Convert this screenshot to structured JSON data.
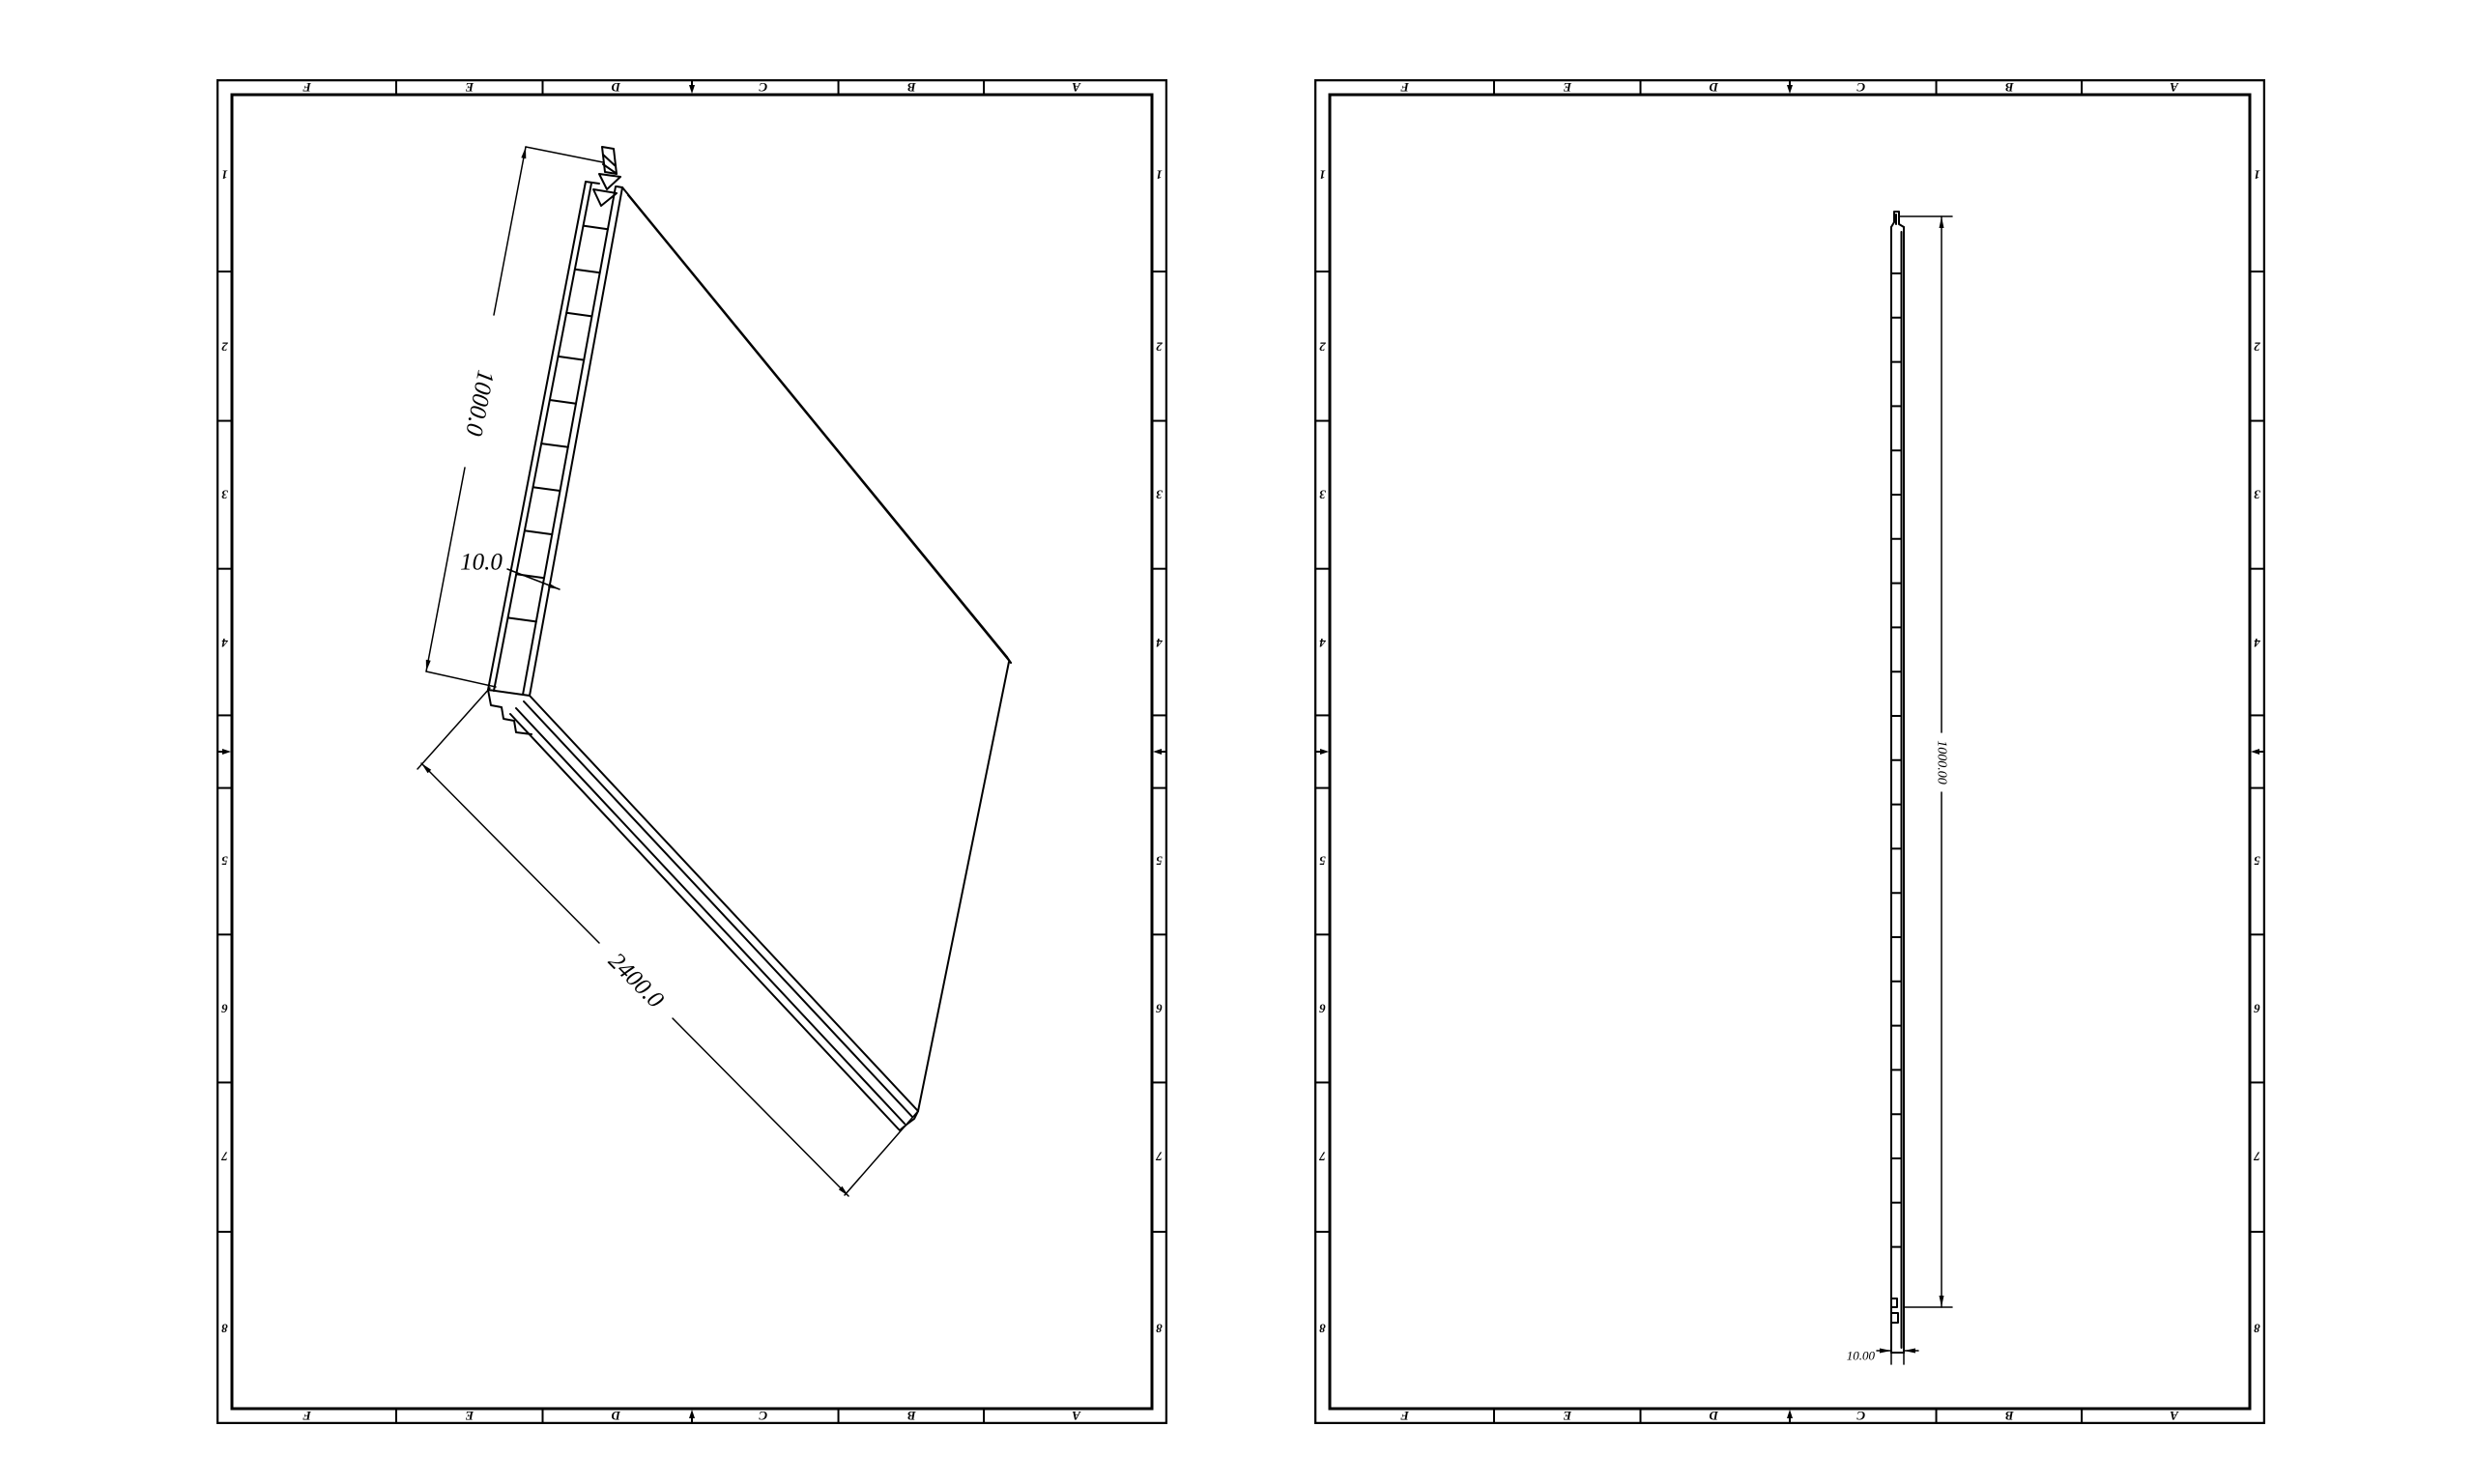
{
  "page": {
    "background": "#ffffff",
    "line_color": "#000000",
    "description": "Two CAD drawing sheets of a hollow-core panel"
  },
  "sheets": [
    {
      "id": "left",
      "view_name": "panel-isometric-view",
      "frame": {
        "column_labels": [
          "F",
          "E",
          "D",
          "C",
          "B",
          "A"
        ],
        "row_labels": [
          "1",
          "2",
          "3",
          "4",
          "5",
          "6",
          "7",
          "8"
        ]
      },
      "dimensions": {
        "length": "1000.0",
        "thickness": "10.0",
        "width": "2400.0"
      }
    },
    {
      "id": "right",
      "view_name": "panel-side-view",
      "frame": {
        "column_labels": [
          "F",
          "E",
          "D",
          "C",
          "B",
          "A"
        ],
        "row_labels": [
          "1",
          "2",
          "3",
          "4",
          "5",
          "6",
          "7",
          "8"
        ]
      },
      "dimensions": {
        "length": "1000.00",
        "thickness": "10.00"
      }
    }
  ]
}
